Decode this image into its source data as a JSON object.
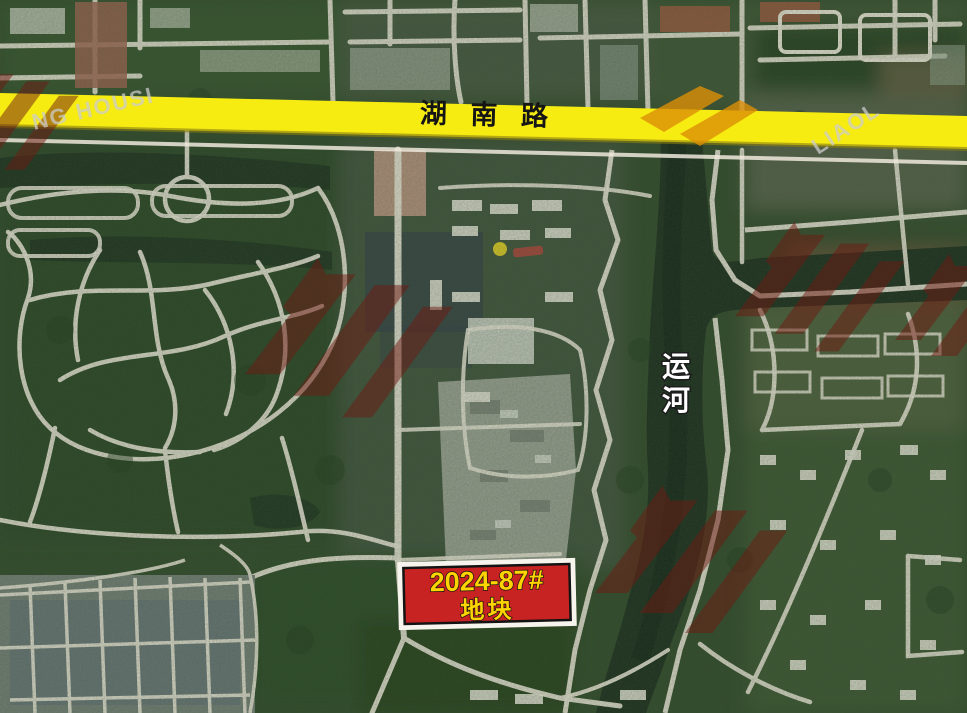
{
  "map": {
    "highlighted_road": {
      "label": "湖 南 路",
      "color": "#f6ec12",
      "label_color": "#151515"
    },
    "canal": {
      "chars": [
        "运",
        "河"
      ],
      "label_color": "#ffffff",
      "water_color": "#1b2d1e"
    },
    "plot_marker": {
      "line1": "2024-87#",
      "line2": "地块",
      "fill_color": "#c62322",
      "text_color": "#ffd400",
      "frame_outer_color": "#f6f4ec",
      "frame_inner_color": "#131313"
    },
    "watermarks": {
      "fragments": [
        "NG HOUSI",
        "LIAOL"
      ],
      "logo_color": "#6e1a12",
      "accent_color": "#dd8f07",
      "text_color": "#cccccc"
    }
  }
}
